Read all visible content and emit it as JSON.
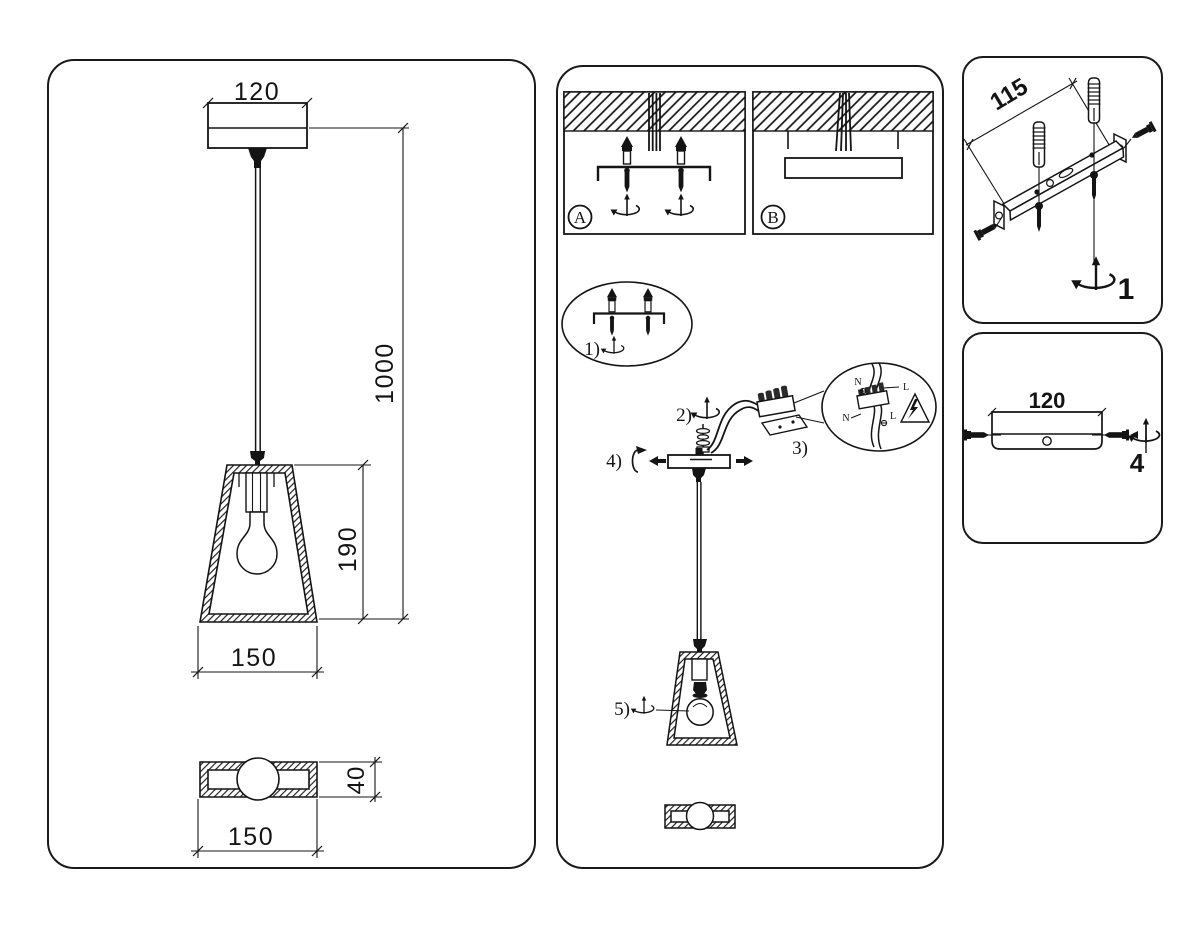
{
  "page": {
    "background": "#ffffff",
    "line_color": "#141414"
  },
  "left_panel": {
    "dim_canopy_width": "120",
    "dim_drop_length": "1000",
    "dim_shade_height": "190",
    "dim_shade_diameter": "150",
    "dim_base_height": "40",
    "dim_base_diameter": "150"
  },
  "install_panel": {
    "option_a": "A",
    "option_b": "B",
    "step1": "1)",
    "step2": "2)",
    "step3": "3)",
    "step4": "4)",
    "step5": "5)",
    "wiring": {
      "neutral_top": "N",
      "live_top": "L",
      "neutral_bottom": "N",
      "live_bottom": "L"
    }
  },
  "bracket_panel": {
    "dim_bracket_length": "115",
    "step_number": "1"
  },
  "canopy_panel": {
    "dim_canopy_width": "120",
    "step_number": "4"
  }
}
